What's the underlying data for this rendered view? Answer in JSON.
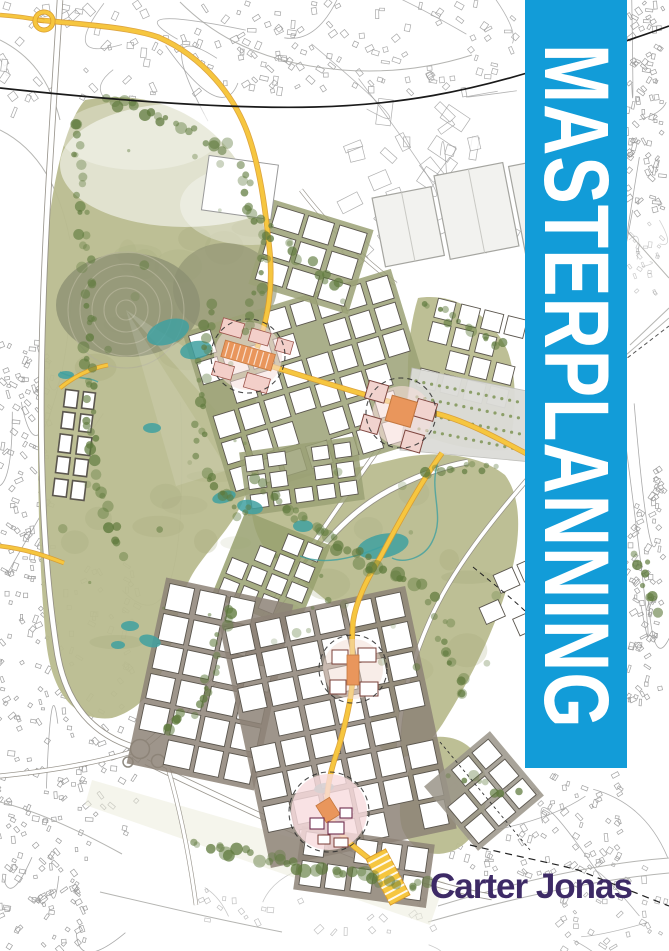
{
  "cover": {
    "title": "MASTERPLANNING",
    "brand": "Carter Jonas",
    "colors": {
      "banner_blue": "#129CD8",
      "brand_purple": "#3D2A66",
      "park_green": "#B9BC8F",
      "park_texture": "#A2A678",
      "tree_green": "#5F7A3D",
      "mound_green": "#8C8F72",
      "water_teal": "#3FA0A0",
      "road_yellow": "#F6C63F",
      "road_yellow_edge": "#D99A2B",
      "landmark_orange": "#E9965C",
      "pink_block": "#F3CFC9",
      "street_grey": "#8D8377",
      "linework_grey": "#9B9B9B",
      "rail_black": "#1A1A1A"
    }
  }
}
